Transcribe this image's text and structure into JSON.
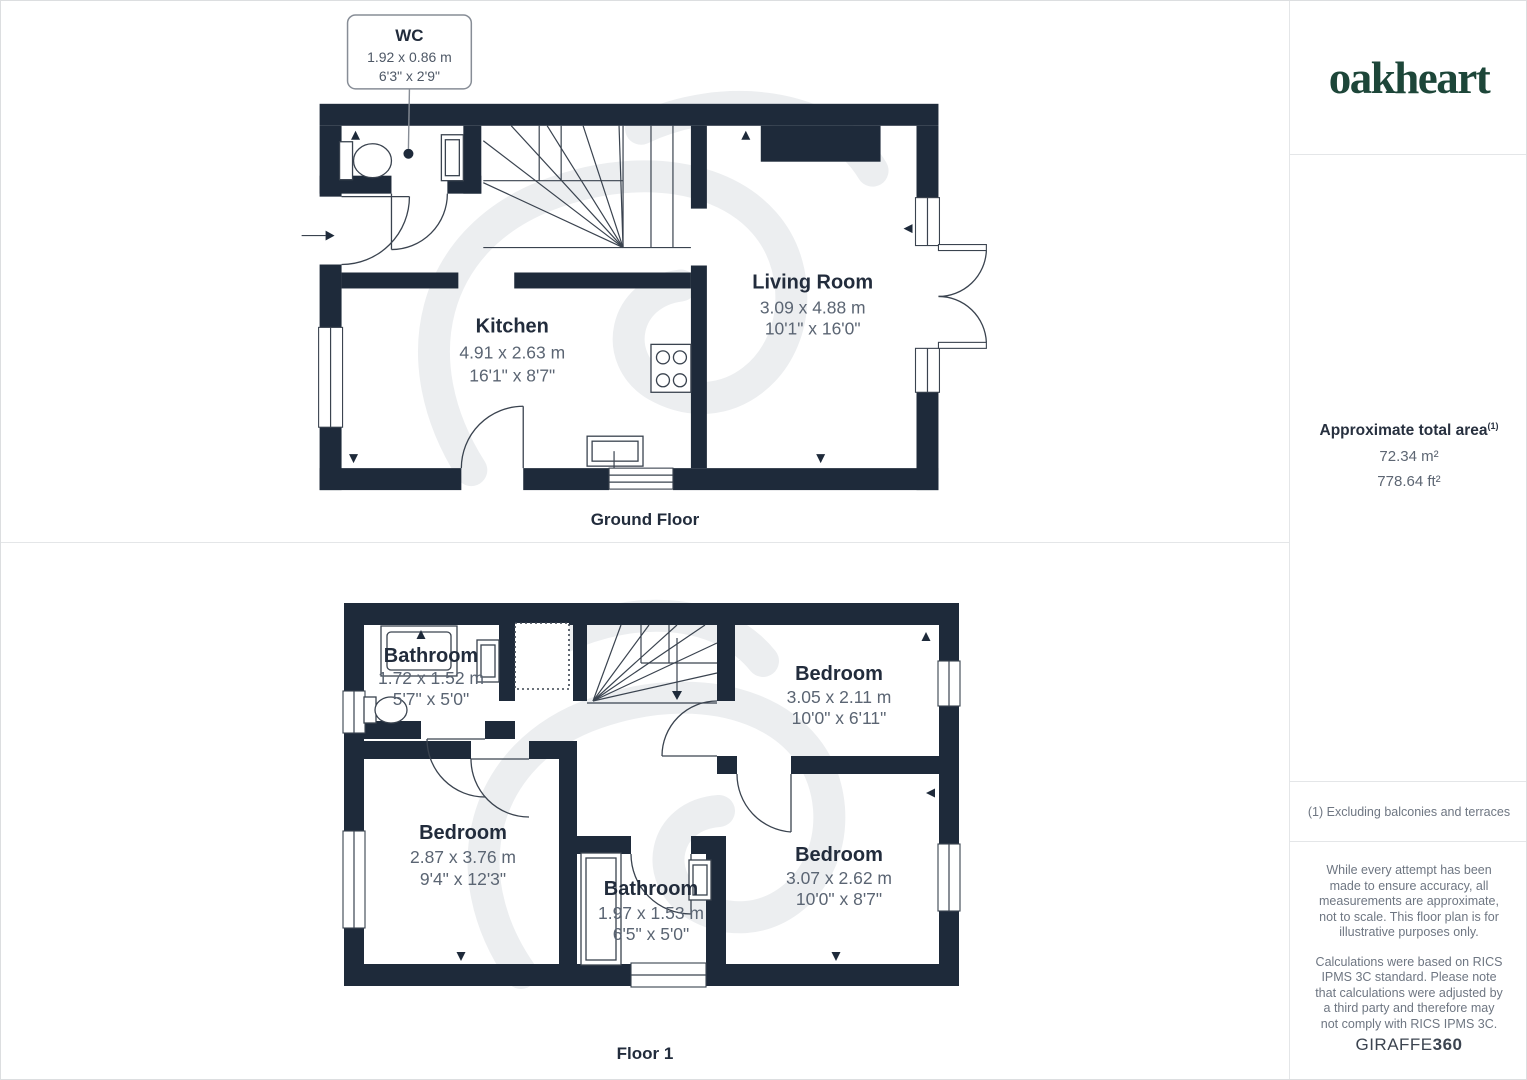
{
  "colors": {
    "wall": "#1e2a3a",
    "room_name": "#222c3c",
    "room_dims": "#5b6573",
    "fixture_line": "#3a434f",
    "logo_green": "#1d4639",
    "sidebar_text": "#6e7682",
    "divider": "#e4e6e8",
    "watermark": "#eceef0"
  },
  "brand": {
    "logo": "oakheart"
  },
  "sidebar": {
    "area_title": "Approximate total area",
    "area_superscript": "(1)",
    "area_m2": "72.34 m²",
    "area_ft2": "778.64 ft²",
    "footnote": "(1) Excluding balconies and terraces",
    "disclaimer_1": "While every attempt has been made to ensure accuracy, all measurements are approximate, not to scale. This floor plan is for illustrative purposes only.",
    "disclaimer_2": "Calculations were based on RICS IPMS 3C standard. Please note that calculations were adjusted by a third party and therefore may not comply with RICS IPMS 3C.",
    "brand_name": "GIRAFFE",
    "brand_number": "360"
  },
  "ground_floor": {
    "label": "Ground Floor",
    "callout": {
      "name": "WC",
      "metric": "1.92 x 0.86 m",
      "imperial": "6'3\" x 2'9\""
    },
    "rooms": {
      "kitchen": {
        "name": "Kitchen",
        "metric": "4.91 x 2.63 m",
        "imperial": "16'1\" x 8'7\""
      },
      "living_room": {
        "name": "Living Room",
        "metric": "3.09 x 4.88 m",
        "imperial": "10'1\" x 16'0\""
      }
    }
  },
  "floor_1": {
    "label": "Floor 1",
    "rooms": {
      "bathroom_top": {
        "name": "Bathroom",
        "metric": "1.72 x 1.52 m",
        "imperial": "5'7\" x 5'0\""
      },
      "bedroom_top_right": {
        "name": "Bedroom",
        "metric": "3.05 x 2.11 m",
        "imperial": "10'0\" x 6'11\""
      },
      "bedroom_left": {
        "name": "Bedroom",
        "metric": "2.87 x 3.76 m",
        "imperial": "9'4\" x 12'3\""
      },
      "bathroom_bottom": {
        "name": "Bathroom",
        "metric": "1.97 x 1.53 m",
        "imperial": "6'5\" x 5'0\""
      },
      "bedroom_bottom_right": {
        "name": "Bedroom",
        "metric": "3.07 x 2.62 m",
        "imperial": "10'0\" x 8'7\""
      }
    }
  }
}
